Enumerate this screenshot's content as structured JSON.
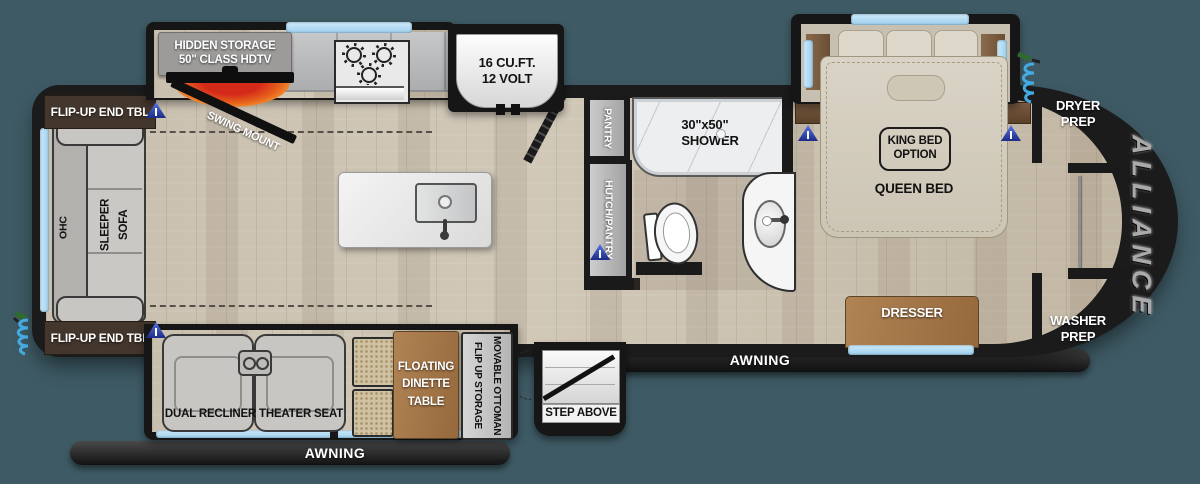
{
  "canvas": {
    "width": 1200,
    "height": 484,
    "background": "#3e5a64"
  },
  "colors": {
    "walls": "#1a1a1a",
    "window_blue": "#a9d7f0",
    "floor_wood": "#c6bcab",
    "furniture_wood": "#a87f52",
    "marker_blue": "#2f4fc0",
    "hose_blue": "#45aae2",
    "brand_metal": "#a9a9a9"
  },
  "labels": {
    "brand": "ALLIANCE",
    "flip_top": "FLIP-UP END TBL",
    "flip_bottom": "FLIP-UP END TBL",
    "ohc": "OHC",
    "sleeper_sofa": "SLEEPER\nSOFA",
    "hidden_storage": "HIDDEN STORAGE\n50\" CLASS HDTV",
    "swing_mount": "SWING MOUNT",
    "fridge": "16 CU.FT.\n12 VOLT",
    "pantry": "PANTRY",
    "hutch_pantry": "HUTCH/PANTRY",
    "shower": "30\"x50\"\nSHOWER",
    "king_bed": "KING BED\nOPTION",
    "queen_bed": "QUEEN BED",
    "dryer_prep": "DRYER\nPREP",
    "washer_prep": "WASHER\nPREP",
    "dresser": "DRESSER",
    "awning_front": "AWNING",
    "awning_rear": "AWNING",
    "step_above": "STEP ABOVE",
    "theater": "DUAL RECLINER THEATER SEAT",
    "dinette": "FLOATING\nDINETTE\nTABLE",
    "ottoman": "MOVABLE OTTOMAN\nFLIP UP STORAGE"
  },
  "icons": {
    "port_marker": "blue triangle charging-port marker",
    "hose": "coiled spray hose",
    "burner": "stove burner",
    "sink": "kitchen sink",
    "toilet": "toilet",
    "shower_drain": "shower control"
  }
}
